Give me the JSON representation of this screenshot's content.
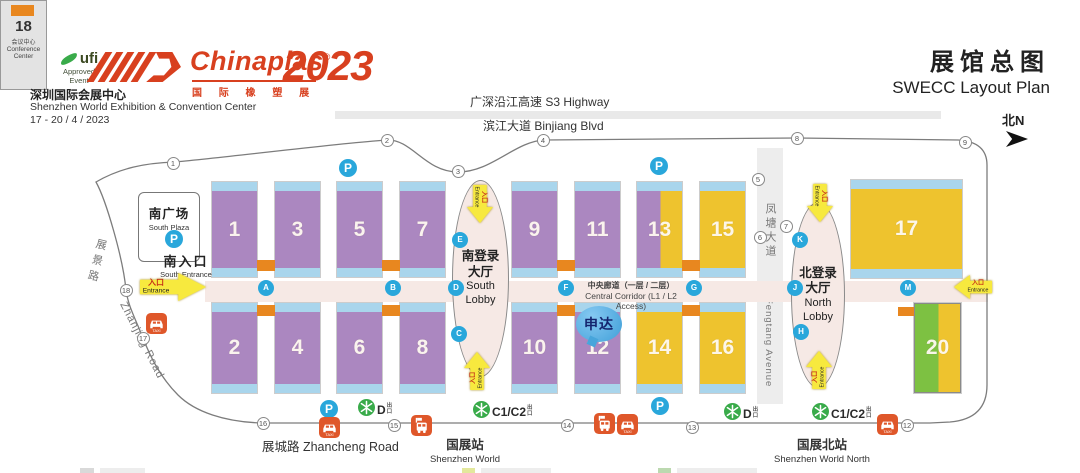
{
  "header": {
    "ufi": {
      "name": "ufi",
      "line2": "Approved",
      "line3": "Event"
    },
    "logo": {
      "brand": "Chinaplas",
      "reg": "®",
      "cn_sub": "国 际 橡 塑 展",
      "year": "2023"
    },
    "venue_cn": "深圳国际会展中心",
    "venue_en": "Shenzhen World Exhibition & Convention Center",
    "dates": "17 - 20 / 4 / 2023",
    "title_cn": "展馆总图",
    "title_en": "SWECC Layout Plan",
    "compass": "北N"
  },
  "map": {
    "colors": {
      "brand": "#d8401f",
      "purple": "#ab87c0",
      "yellow": "#eec32e",
      "strip": "#a9d5ec",
      "orange": "#e8871f",
      "pink": "#f6e9e5",
      "blueicon": "#29a7db",
      "metrogreen": "#39ab4a",
      "taxiorange": "#df572a",
      "arrowyellow": "#f7e93e",
      "hallgreen": "#7dc142"
    },
    "roads": {
      "highway": "广深沿江高速 S3 Highway",
      "binjiang": "滨江大道 Binjiang Blvd",
      "zhanjing_cn": "展景路",
      "zhanjing_en": "Zhanjing Road",
      "zhancheng": "展城路 Zhancheng Road",
      "fengtang_cn": "凤塘大道",
      "fengtang_en": "Fengtang Avenue"
    },
    "stations": [
      {
        "cn": "国展站",
        "en": "Shenzhen World"
      },
      {
        "cn": "国展北站",
        "en": "Shenzhen World North"
      }
    ],
    "corridor": {
      "cn": "中央廊道（一层 / 二层）",
      "en": "Central Corridor (L1 / L2 Access)"
    },
    "south_plaza": {
      "cn": "南广场",
      "en": "South Plaza"
    },
    "south_entrance": {
      "cn": "南入口",
      "en": "South Entrance"
    },
    "entrance": {
      "cn": "入口",
      "en": "Entrance"
    },
    "lobbies": {
      "south": {
        "cn1": "南登录",
        "cn2": "大厅",
        "en1": "South",
        "en2": "Lobby"
      },
      "north": {
        "cn1": "北登录",
        "cn2": "大厅",
        "en1": "North",
        "en2": "Lobby"
      }
    },
    "conference": {
      "num": "18",
      "cn": "会议中心",
      "en1": "Conference",
      "en2": "Center"
    },
    "exhibitor_badge": "申达",
    "metro_exit_suffix": "出口",
    "halls": [
      {
        "label": "1",
        "x": 212,
        "y": 182,
        "w": 45,
        "h": 95,
        "type": "purple"
      },
      {
        "label": "3",
        "x": 275,
        "y": 182,
        "w": 45,
        "h": 95,
        "type": "purple"
      },
      {
        "label": "5",
        "x": 337,
        "y": 182,
        "w": 45,
        "h": 95,
        "type": "purple"
      },
      {
        "label": "7",
        "x": 400,
        "y": 182,
        "w": 45,
        "h": 95,
        "type": "purple"
      },
      {
        "label": "9",
        "x": 512,
        "y": 182,
        "w": 45,
        "h": 95,
        "type": "purple"
      },
      {
        "label": "11",
        "x": 575,
        "y": 182,
        "w": 45,
        "h": 95,
        "type": "purple"
      },
      {
        "label": "13",
        "x": 637,
        "y": 182,
        "w": 45,
        "h": 95,
        "type": "purple-yellow"
      },
      {
        "label": "15",
        "x": 700,
        "y": 182,
        "w": 45,
        "h": 95,
        "type": "yellow"
      },
      {
        "label": "17",
        "x": 851,
        "y": 180,
        "w": 111,
        "h": 98,
        "type": "yellow"
      },
      {
        "label": "2",
        "x": 212,
        "y": 303,
        "w": 45,
        "h": 90,
        "type": "purple"
      },
      {
        "label": "4",
        "x": 275,
        "y": 303,
        "w": 45,
        "h": 90,
        "type": "purple"
      },
      {
        "label": "6",
        "x": 337,
        "y": 303,
        "w": 45,
        "h": 90,
        "type": "purple"
      },
      {
        "label": "8",
        "x": 400,
        "y": 303,
        "w": 45,
        "h": 90,
        "type": "purple"
      },
      {
        "label": "10",
        "x": 512,
        "y": 303,
        "w": 45,
        "h": 90,
        "type": "purple"
      },
      {
        "label": "12",
        "x": 575,
        "y": 303,
        "w": 45,
        "h": 90,
        "type": "purple"
      },
      {
        "label": "14",
        "x": 637,
        "y": 303,
        "w": 45,
        "h": 90,
        "type": "yellow"
      },
      {
        "label": "16",
        "x": 700,
        "y": 303,
        "w": 45,
        "h": 90,
        "type": "yellow"
      },
      {
        "label": "20",
        "x": 914,
        "y": 303,
        "w": 47,
        "h": 90,
        "type": "green-yellow",
        "no_strips": true
      }
    ],
    "connectors": [
      {
        "x": 257,
        "y": 260,
        "w": 18,
        "h": 11
      },
      {
        "x": 382,
        "y": 260,
        "w": 18,
        "h": 11
      },
      {
        "x": 557,
        "y": 260,
        "w": 18,
        "h": 11
      },
      {
        "x": 682,
        "y": 260,
        "w": 18,
        "h": 11
      },
      {
        "x": 257,
        "y": 305,
        "w": 18,
        "h": 11
      },
      {
        "x": 382,
        "y": 305,
        "w": 18,
        "h": 11
      },
      {
        "x": 557,
        "y": 305,
        "w": 18,
        "h": 11
      },
      {
        "x": 682,
        "y": 305,
        "w": 18,
        "h": 11
      },
      {
        "x": 898,
        "y": 307,
        "w": 16,
        "h": 9
      }
    ],
    "gate_numbers": [
      {
        "n": "1",
        "x": 173,
        "y": 163
      },
      {
        "n": "2",
        "x": 387,
        "y": 140
      },
      {
        "n": "3",
        "x": 458,
        "y": 171
      },
      {
        "n": "4",
        "x": 543,
        "y": 140
      },
      {
        "n": "5",
        "x": 758,
        "y": 179
      },
      {
        "n": "6",
        "x": 760,
        "y": 237
      },
      {
        "n": "7",
        "x": 786,
        "y": 226
      },
      {
        "n": "8",
        "x": 797,
        "y": 138
      },
      {
        "n": "9",
        "x": 965,
        "y": 142
      },
      {
        "n": "12",
        "x": 907,
        "y": 425
      },
      {
        "n": "13",
        "x": 692,
        "y": 427
      },
      {
        "n": "14",
        "x": 567,
        "y": 425
      },
      {
        "n": "15",
        "x": 394,
        "y": 425
      },
      {
        "n": "16",
        "x": 263,
        "y": 423
      },
      {
        "n": "17",
        "x": 143,
        "y": 338
      },
      {
        "n": "18",
        "x": 126,
        "y": 290
      }
    ],
    "access_points": [
      {
        "letter": "A",
        "x": 266,
        "y": 288
      },
      {
        "letter": "B",
        "x": 393,
        "y": 288
      },
      {
        "letter": "C",
        "x": 459,
        "y": 334
      },
      {
        "letter": "D",
        "x": 456,
        "y": 288
      },
      {
        "letter": "E",
        "x": 460,
        "y": 240
      },
      {
        "letter": "F",
        "x": 566,
        "y": 288
      },
      {
        "letter": "G",
        "x": 694,
        "y": 288
      },
      {
        "letter": "H",
        "x": 801,
        "y": 332
      },
      {
        "letter": "J",
        "x": 795,
        "y": 288
      },
      {
        "letter": "K",
        "x": 800,
        "y": 240
      },
      {
        "letter": "M",
        "x": 908,
        "y": 288
      }
    ],
    "parking": [
      {
        "x": 174,
        "y": 239
      },
      {
        "x": 348,
        "y": 168
      },
      {
        "x": 659,
        "y": 166
      },
      {
        "x": 329,
        "y": 409
      },
      {
        "x": 660,
        "y": 406
      }
    ],
    "taxis": [
      {
        "x": 156,
        "y": 323
      },
      {
        "x": 329,
        "y": 427
      },
      {
        "x": 627,
        "y": 424
      },
      {
        "x": 887,
        "y": 424
      }
    ],
    "buses": [
      {
        "x": 421,
        "y": 425
      },
      {
        "x": 604,
        "y": 423
      }
    ],
    "metro_exits": [
      {
        "label": "D",
        "x": 367,
        "y": 408
      },
      {
        "label": "C1/C2",
        "x": 482,
        "y": 410
      },
      {
        "label": "D",
        "x": 733,
        "y": 412
      },
      {
        "label": "C1/C2",
        "x": 821,
        "y": 412
      }
    ],
    "arrows": [
      {
        "x": 173,
        "y": 287,
        "w": 66,
        "h": 28,
        "dir": "right",
        "big": true
      },
      {
        "x": 973,
        "y": 287,
        "w": 38,
        "h": 24,
        "dir": "left"
      },
      {
        "x": 480,
        "y": 204,
        "w": 38,
        "h": 26,
        "dir": "down"
      },
      {
        "x": 477,
        "y": 371,
        "w": 38,
        "h": 26,
        "dir": "up"
      },
      {
        "x": 820,
        "y": 203,
        "w": 38,
        "h": 26,
        "dir": "down"
      },
      {
        "x": 819,
        "y": 370,
        "w": 38,
        "h": 26,
        "dir": "up"
      }
    ]
  }
}
